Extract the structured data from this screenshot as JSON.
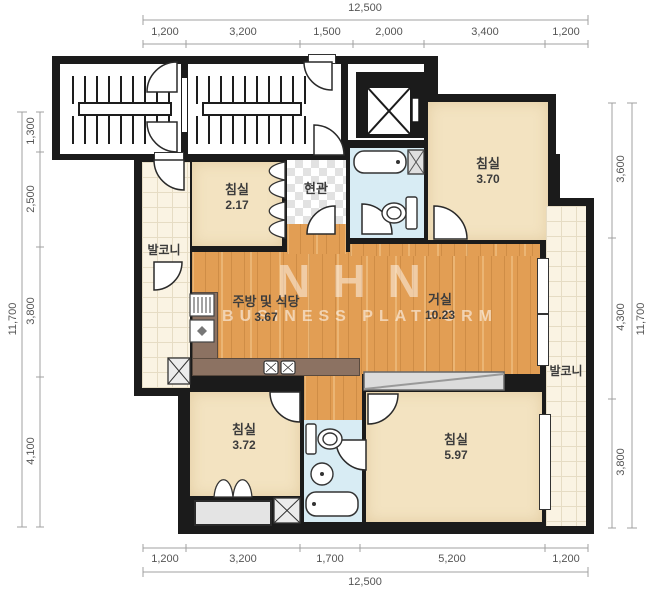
{
  "watermark": {
    "line1": "NHN",
    "line2": "BUSINESS PLATFORM"
  },
  "rooms": [
    {
      "id": "bedroom-top-left",
      "label": "침실",
      "area": "2.17"
    },
    {
      "id": "bedroom-top-right",
      "label": "침실",
      "area": "3.70"
    },
    {
      "id": "entrance",
      "label": "현관",
      "area": ""
    },
    {
      "id": "balcony-left",
      "label": "발코니",
      "area": ""
    },
    {
      "id": "kitchen-dining",
      "label": "주방 및 식당",
      "area": "3.67"
    },
    {
      "id": "living-room",
      "label": "거실",
      "area": "10.23"
    },
    {
      "id": "balcony-right",
      "label": "발코니",
      "area": ""
    },
    {
      "id": "bedroom-bottom-left",
      "label": "침실",
      "area": "3.72"
    },
    {
      "id": "bedroom-bottom-right",
      "label": "침실",
      "area": "5.97"
    }
  ],
  "dimensions": {
    "top": {
      "total": "12,500",
      "segments": [
        "1,200",
        "3,200",
        "1,500",
        "2,000",
        "3,400",
        "1,200"
      ]
    },
    "bottom": {
      "total": "12,500",
      "segments": [
        "1,200",
        "3,200",
        "1,700",
        "5,200",
        "1,200"
      ]
    },
    "left": {
      "total": "11,700",
      "segments": [
        "1,300",
        "2,500",
        "3,800",
        "4,100"
      ]
    },
    "right": {
      "total": "11,700",
      "segments": [
        "3,600",
        "4,300",
        "3,800"
      ]
    }
  },
  "colors": {
    "wall": "#1b1b1b",
    "wood_floor": "#e29e54",
    "room_fill": "#f3e3c1",
    "bathroom_fill": "#d8ecf4",
    "balcony_tile": "#faf3e3",
    "kitchen_counter": "#8c7262",
    "dimension_text": "#555555"
  }
}
